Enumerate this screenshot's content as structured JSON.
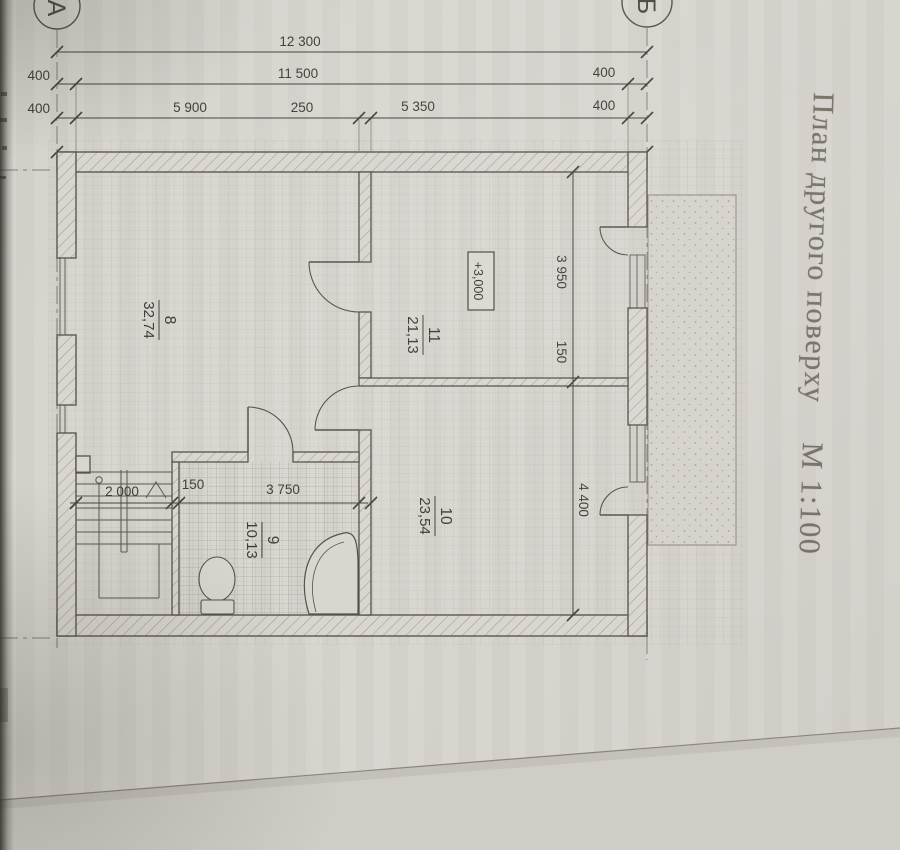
{
  "document": {
    "title": "План другого поверху",
    "scale_note": "М 1:100",
    "axes": {
      "left": "А",
      "right": "Б"
    },
    "dimensions": {
      "overall": "12 300",
      "row2": {
        "left": "400",
        "middle": "11 500",
        "right": "400"
      },
      "row3": {
        "left": "400",
        "d1": "5 900",
        "d2": "250",
        "d3": "5 350",
        "right": "400"
      },
      "vertical": {
        "top": "3 950",
        "middle": "150",
        "bottom": "4 400"
      },
      "lower": {
        "stairs": "2 000",
        "wall": "150",
        "bathroom": "3 750"
      }
    },
    "elevation_mark": "+3,000",
    "rooms": [
      {
        "number": "8",
        "area": "32,74"
      },
      {
        "number": "11",
        "area": "21,13"
      },
      {
        "number": "10",
        "area": "23,54"
      },
      {
        "number": "9",
        "area": "10,13"
      }
    ]
  }
}
